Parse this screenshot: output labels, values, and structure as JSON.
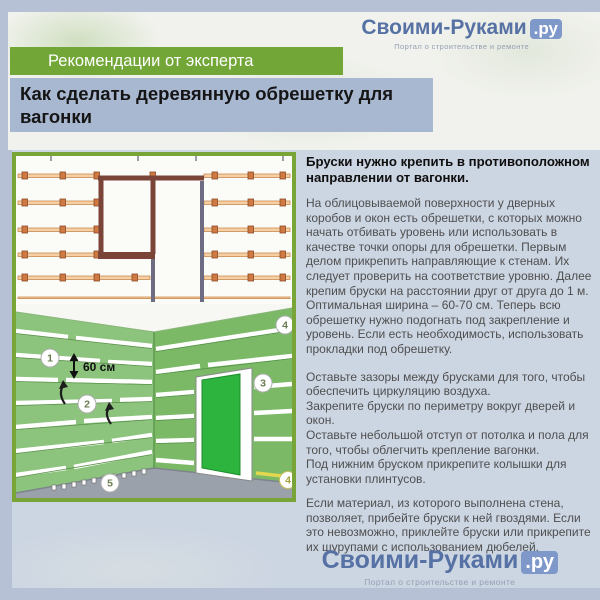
{
  "colors": {
    "page-bg": "#b7c1d5",
    "panel-bg": "#ccd5e2",
    "band-green": "#72a637",
    "title-band": "#a9b8d1",
    "brand-blue": "#5671a4",
    "badge-blue": "#7f98ca",
    "frame-green": "#79a437",
    "wall-left": "#8cc47d",
    "wall-right": "#7bb967",
    "door-green": "#2db43e",
    "batten-tan": "#f6cfa4",
    "frame-brown": "#7a4538",
    "floor-gray": "#9aa1ab"
  },
  "logo": {
    "brand": "Своими-Руками",
    "tld": ".ру",
    "tagline": "Портал о строительстве и ремонте"
  },
  "header": {
    "badge": "Рекомендации от эксперта",
    "title": "Как сделать деревянную обрешетку для вагонки"
  },
  "article": {
    "lead": "Бруски нужно крепить в противоположном направлении от вагонки.",
    "intro": "На облицовываемой поверхности у дверных коробов и окон есть обрешетки, с которых можно начать отбивать уровень или использовать в качестве точки опоры для обрешетки. Первым делом прикрепить направляющие к стенам. Их следует проверить на соответствие уровню. Далее крепим бруски на расстоянии друг от друга до 1 м. Оптимальная ширина – 60-70 см. Теперь всю обрешетку нужно подогнать под закрепление и уровень. Если есть необходимость, использовать прокладки под обрешетку.",
    "tips": [
      "Оставьте зазоры между брусками для того, чтобы обеспечить циркуляцию воздуха.",
      "Закрепите бруски по периметру вокруг дверей и окон.",
      "Оставьте небольшой отступ от потолка и пола для того, чтобы облегчить крепление вагонки.",
      "Под нижним бруском прикрепите колышки для установки плинтусов."
    ],
    "closing": "Если материал, из которого выполнена стена, позволяет, прибейте бруски к ней гвоздями. Если это невозможно, приклейте бруски или прикрепите их шурупами с использованием дюбелей."
  },
  "figure": {
    "dimension_label": "60 см",
    "callouts": [
      "1",
      "2",
      "3",
      "4",
      "5",
      "4"
    ]
  }
}
